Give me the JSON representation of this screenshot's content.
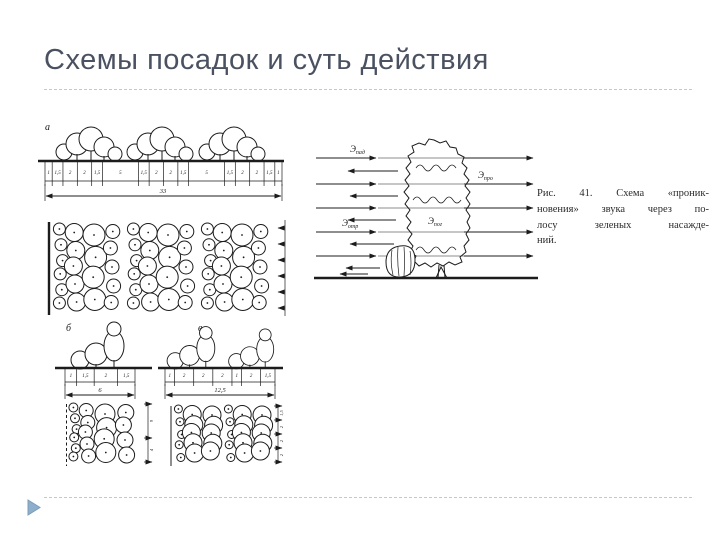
{
  "slide": {
    "title": "Схемы посадок и суть действия"
  },
  "figure_left": {
    "section_a": {
      "label": "а",
      "cells": [
        "1",
        "1,5",
        "2",
        "2",
        "1,5",
        "5",
        "1,5",
        "2",
        "2",
        "1,5",
        "5",
        "1,5",
        "2",
        "2",
        "1,5",
        "1"
      ],
      "total": "33"
    },
    "section_b": {
      "label": "б",
      "cells": [
        "1",
        "1,5",
        "2",
        "1,5"
      ],
      "total": "6",
      "plan_dims": [
        "9",
        "4"
      ]
    },
    "section_v": {
      "label": "в",
      "cells": [
        "1",
        "2",
        "2",
        "2",
        "1",
        "2",
        "1,5"
      ],
      "total": "12,5",
      "plan_dims": [
        "1,5",
        "2",
        "2",
        "2"
      ]
    }
  },
  "figure_right": {
    "labels": {
      "incident": {
        "base": "Э",
        "sub": "пад"
      },
      "reflected": {
        "base": "Э",
        "sub": "отр"
      },
      "transmitted": {
        "base": "Э",
        "sub": "про"
      },
      "absorbed": {
        "base": "Э",
        "sub": "пог"
      }
    }
  },
  "caption": {
    "lines": [
      "Рис. 41. Схема «проник-",
      "новения» звука через по-",
      "лосу зеленых насажде-",
      "ний."
    ]
  },
  "colors": {
    "title": "#4a5160",
    "ink": "#1c1c1c",
    "rule": "#c5c7ca",
    "accent_triangle": "#8dafcc"
  }
}
